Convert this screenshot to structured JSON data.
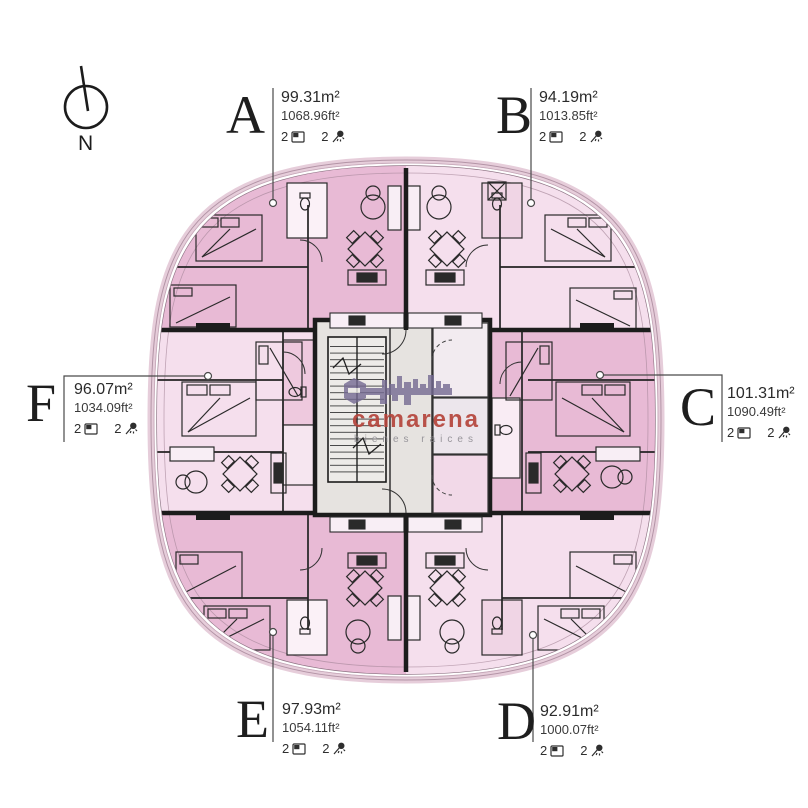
{
  "compass": {
    "label": "N"
  },
  "watermark": {
    "brand": "camarena",
    "tagline": "bienes raices"
  },
  "units": {
    "A": {
      "letter": "A",
      "area_m2": "99.31m²",
      "area_ft2": "1068.96ft²",
      "beds": "2",
      "baths": "2"
    },
    "B": {
      "letter": "B",
      "area_m2": "94.19m²",
      "area_ft2": "1013.85ft²",
      "beds": "2",
      "baths": "2"
    },
    "C": {
      "letter": "C",
      "area_m2": "101.31m²",
      "area_ft2": "1090.49ft²",
      "beds": "2",
      "baths": "2"
    },
    "D": {
      "letter": "D",
      "area_m2": "92.91m²",
      "area_ft2": "1000.07ft²",
      "beds": "2",
      "baths": "2"
    },
    "E": {
      "letter": "E",
      "area_m2": "97.93m²",
      "area_ft2": "1054.11ft²",
      "beds": "2",
      "baths": "2"
    },
    "F": {
      "letter": "F",
      "area_m2": "96.07m²",
      "area_ft2": "1034.09ft²",
      "beds": "2",
      "baths": "2"
    }
  },
  "colors": {
    "unit_dark": "#e8bad5",
    "unit_light": "#f5dfed",
    "core_gray": "#e6e3e0",
    "wall": "#1c1c1c",
    "brand_red": "#b5453c",
    "logo_purple": "#756a92",
    "leader": "#4a4a4a"
  }
}
